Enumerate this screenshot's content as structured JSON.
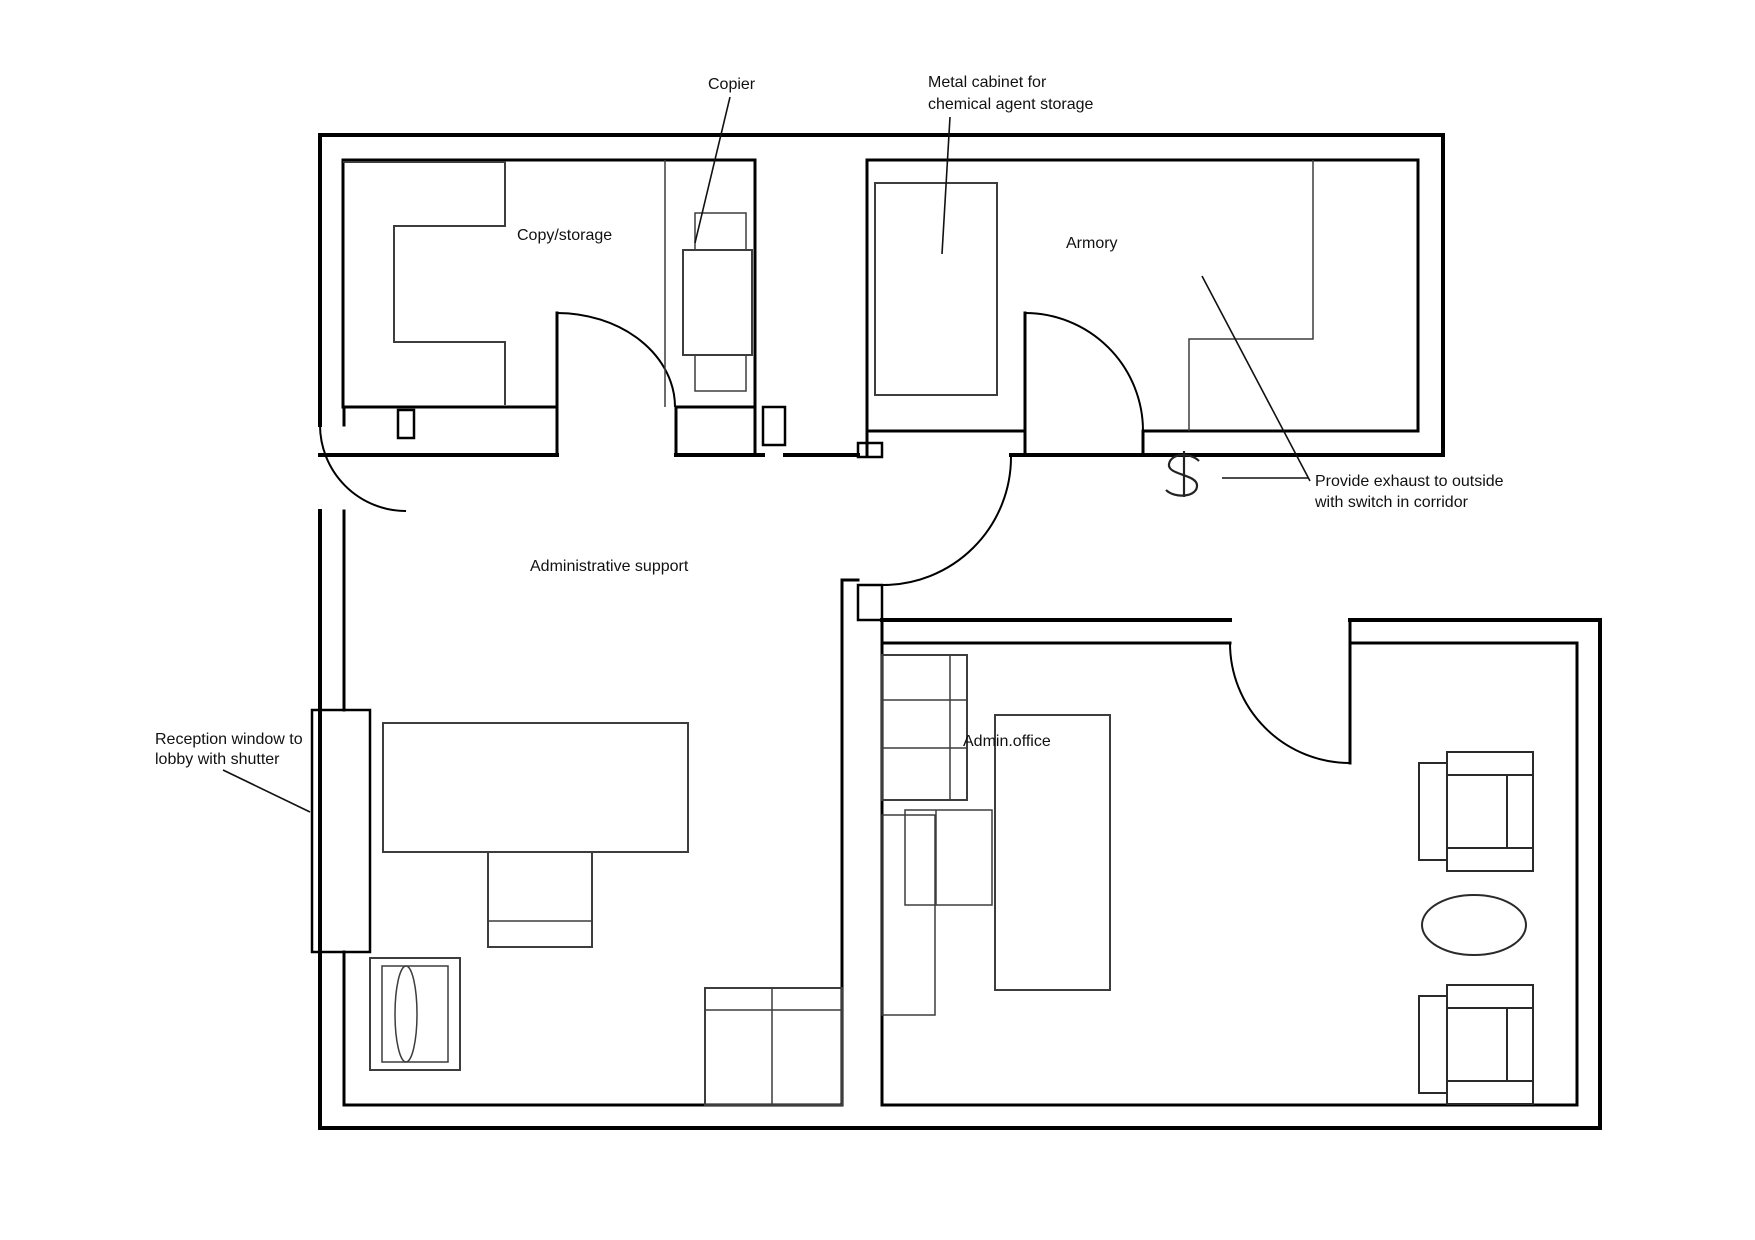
{
  "canvas": {
    "background": "#ffffff",
    "wall_color": "#000000",
    "furniture_color": "#3d3d3d",
    "text_color": "#111111"
  },
  "rooms": [
    {
      "id": "copy-storage",
      "label": "Copy/storage"
    },
    {
      "id": "armory",
      "label": "Armory"
    },
    {
      "id": "admin-support",
      "label": "Administrative support"
    },
    {
      "id": "admin-office",
      "label": "Admin.office"
    }
  ],
  "annotations": [
    {
      "id": "copier",
      "line1": "Copier"
    },
    {
      "id": "metal-cabinet",
      "line1": "Metal cabinet for",
      "line2": "chemical agent storage"
    },
    {
      "id": "exhaust",
      "line1": "Provide exhaust to outside",
      "line2": "with switch in corridor"
    },
    {
      "id": "reception",
      "line1": "Reception window to",
      "line2": "lobby with shutter"
    }
  ],
  "symbols": [
    {
      "id": "exhaust-switch",
      "glyph": "$"
    }
  ]
}
